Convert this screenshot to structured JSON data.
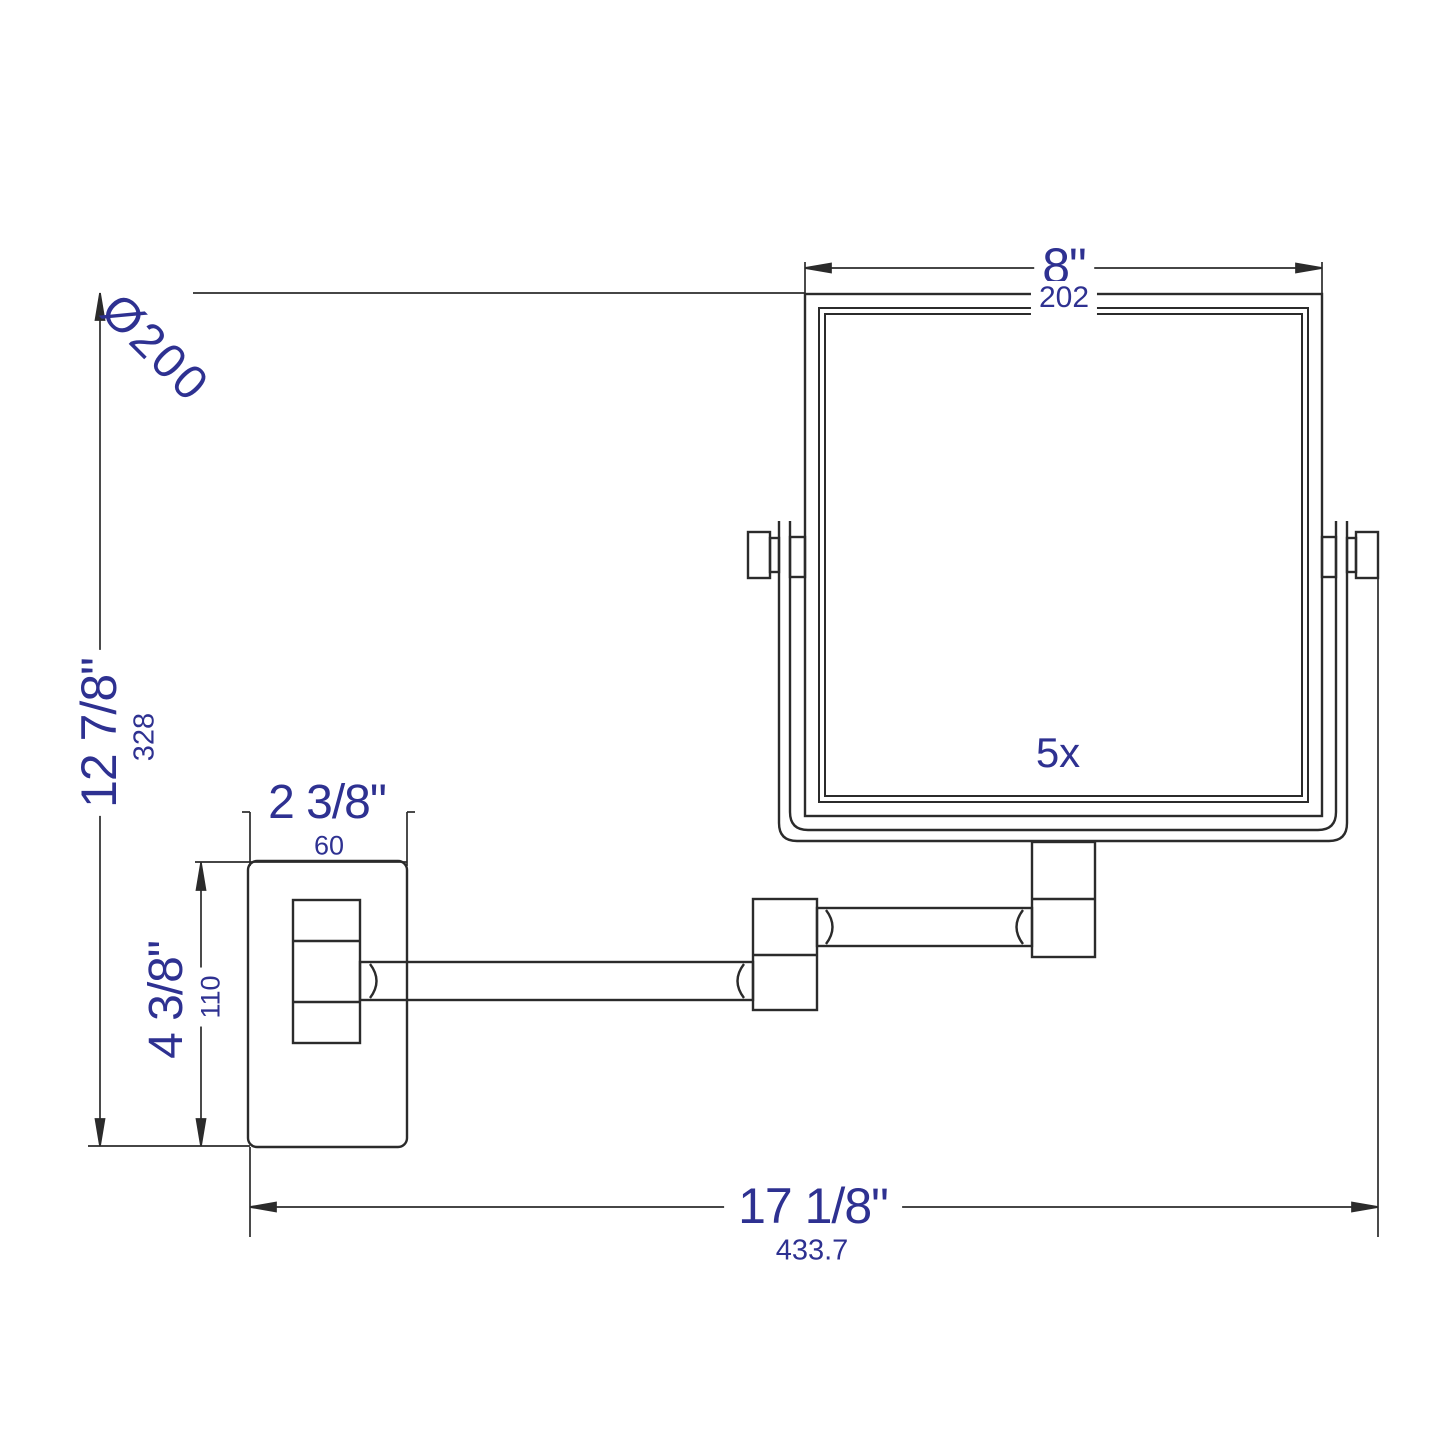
{
  "colors": {
    "line": "#2b2b2b",
    "dimension_text": "#2e3191",
    "background": "#ffffff"
  },
  "annotations": {
    "diameter_label": "Ø200",
    "magnification": "5x"
  },
  "dimensions": {
    "mirror_width": {
      "inches": "8\"",
      "mm": "202"
    },
    "overall_height": {
      "inches": "12 7/8\"",
      "mm": "328"
    },
    "backplate_width": {
      "inches": "2 3/8\"",
      "mm": "60"
    },
    "backplate_height": {
      "inches": "4 3/8\"",
      "mm": "110"
    },
    "overall_width": {
      "inches": "17 1/8\"",
      "mm": "433.7"
    }
  }
}
